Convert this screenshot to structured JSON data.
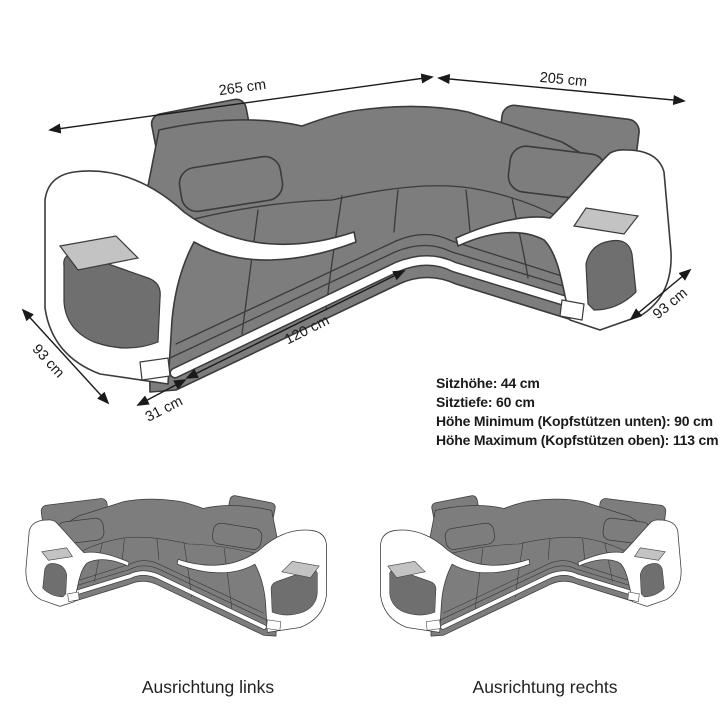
{
  "diagram_title": "corner sofa dimension diagram",
  "dimensions": {
    "top_left": "265 cm",
    "top_right": "205 cm",
    "right_depth": "93 cm",
    "front_seat": "120 cm",
    "front_corner": "31 cm",
    "left_depth": "93 cm"
  },
  "specs": {
    "seat_height": "Sitzhöhe: 44 cm",
    "seat_depth": "Sitztiefe: 60 cm",
    "height_min": "Höhe Minimum (Kopfstützen unten): 90 cm",
    "height_max": "Höhe Maximum (Kopfstützen oben): 113 cm"
  },
  "variants": {
    "left": "Ausrichtung links",
    "right": "Ausrichtung rechts"
  },
  "colors": {
    "sofa_gray": "#7d7d7d",
    "outline": "#3b3b3b",
    "shadow_gray": "#6f6f6f",
    "tray_gray": "#c3c3c3",
    "arm_white": "#ffffff",
    "text": "#1a1a1a",
    "bg": "#ffffff"
  }
}
